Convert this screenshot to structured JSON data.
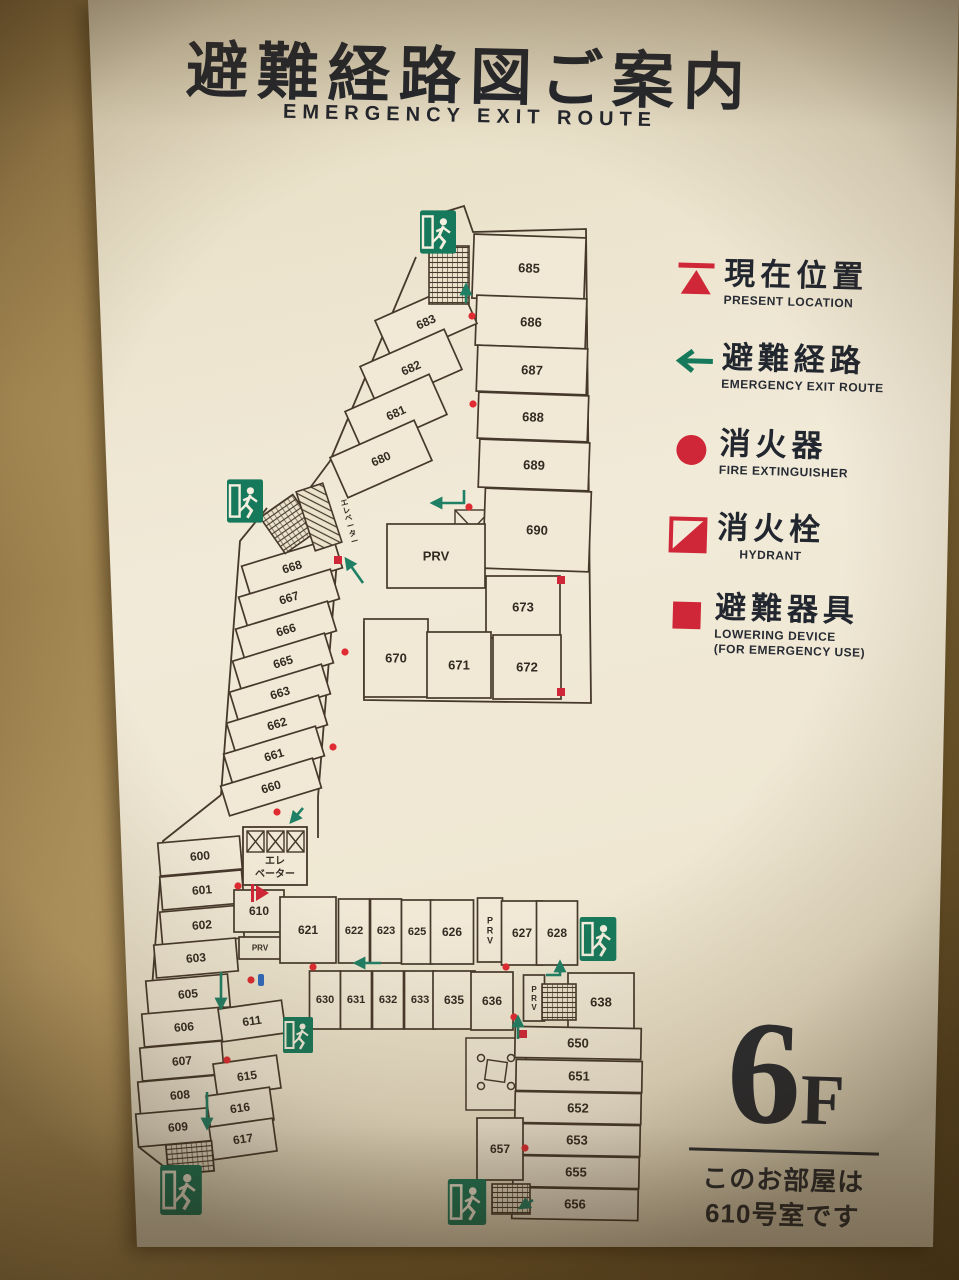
{
  "title": {
    "jp": "避難経路図ご案内",
    "en": "EMERGENCY EXIT ROUTE"
  },
  "legend": {
    "items": [
      {
        "id": "present-location",
        "jp": "現在位置",
        "en": "PRESENT LOCATION"
      },
      {
        "id": "exit-route",
        "jp": "避難経路",
        "en": "EMERGENCY EXIT ROUTE"
      },
      {
        "id": "fire-extinguisher",
        "jp": "消火器",
        "en": "FIRE EXTINGUISHER"
      },
      {
        "id": "hydrant",
        "jp": "消火栓",
        "en": "HYDRANT"
      },
      {
        "id": "lowering-device",
        "jp": "避難器具",
        "en": "LOWERING DEVICE",
        "en2": "(FOR EMERGENCY USE)"
      }
    ]
  },
  "floor": {
    "number": "6",
    "suffix": "F",
    "note1": "このお部屋は",
    "note2": "610号室です"
  },
  "colors": {
    "sign": "#efe7d2",
    "wall_paint": "#9c8150",
    "accent_red": "#d02738",
    "exit_green": "#17795b",
    "plan_line": "#46392b",
    "ink": "#22262e",
    "hose_blue": "#2f6bbf"
  },
  "plan": {
    "elevator": {
      "line1": "エレ",
      "line2": "ベーター"
    },
    "shaft_label": "エレベーター",
    "rooms": [
      {
        "t": "685",
        "x": 529,
        "y": 268,
        "w": 112,
        "h": 64,
        "r": 2
      },
      {
        "t": "686",
        "x": 531,
        "y": 322,
        "w": 110,
        "h": 50,
        "r": 2
      },
      {
        "t": "687",
        "x": 532,
        "y": 370,
        "w": 110,
        "h": 46,
        "r": 2
      },
      {
        "t": "688",
        "x": 533,
        "y": 417,
        "w": 110,
        "h": 46,
        "r": 2
      },
      {
        "t": "689",
        "x": 534,
        "y": 465,
        "w": 110,
        "h": 48,
        "r": 2
      },
      {
        "t": "690",
        "x": 537,
        "y": 530,
        "w": 106,
        "h": 80,
        "r": 2
      },
      {
        "t": "PRV",
        "x": 436,
        "y": 556,
        "w": 98,
        "h": 64,
        "r": 0,
        "fs": 13
      },
      {
        "t": "673",
        "x": 523,
        "y": 607,
        "w": 74,
        "h": 62,
        "r": 0
      },
      {
        "t": "670",
        "x": 396,
        "y": 658,
        "w": 64,
        "h": 78,
        "r": 0
      },
      {
        "t": "671",
        "x": 459,
        "y": 665,
        "w": 64,
        "h": 66,
        "r": 0
      },
      {
        "t": "672",
        "x": 527,
        "y": 667,
        "w": 68,
        "h": 64,
        "r": 0
      },
      {
        "t": "683",
        "x": 426,
        "y": 322,
        "w": 92,
        "h": 44,
        "r": -24,
        "fs": 12
      },
      {
        "t": "682",
        "x": 411,
        "y": 368,
        "w": 92,
        "h": 44,
        "r": -24,
        "fs": 12
      },
      {
        "t": "681",
        "x": 396,
        "y": 413,
        "w": 92,
        "h": 44,
        "r": -24,
        "fs": 12
      },
      {
        "t": "680",
        "x": 381,
        "y": 459,
        "w": 92,
        "h": 44,
        "r": -24,
        "fs": 12
      },
      {
        "t": "668",
        "x": 292,
        "y": 567,
        "w": 96,
        "h": 31,
        "r": -17,
        "fs": 12
      },
      {
        "t": "667",
        "x": 289,
        "y": 598,
        "w": 96,
        "h": 31,
        "r": -17,
        "fs": 12
      },
      {
        "t": "666",
        "x": 286,
        "y": 630,
        "w": 96,
        "h": 31,
        "r": -17,
        "fs": 12
      },
      {
        "t": "665",
        "x": 283,
        "y": 662,
        "w": 96,
        "h": 31,
        "r": -17,
        "fs": 12
      },
      {
        "t": "663",
        "x": 280,
        "y": 693,
        "w": 96,
        "h": 31,
        "r": -17,
        "fs": 12
      },
      {
        "t": "662",
        "x": 277,
        "y": 724,
        "w": 96,
        "h": 31,
        "r": -17,
        "fs": 12
      },
      {
        "t": "661",
        "x": 274,
        "y": 755,
        "w": 96,
        "h": 31,
        "r": -17,
        "fs": 12
      },
      {
        "t": "660",
        "x": 271,
        "y": 787,
        "w": 96,
        "h": 31,
        "r": -17,
        "fs": 12
      },
      {
        "t": "600",
        "x": 200,
        "y": 856,
        "w": 82,
        "h": 33,
        "r": -5,
        "fs": 12
      },
      {
        "t": "601",
        "x": 202,
        "y": 890,
        "w": 82,
        "h": 33,
        "r": -5,
        "fs": 12
      },
      {
        "t": "602",
        "x": 202,
        "y": 925,
        "w": 82,
        "h": 33,
        "r": -5,
        "fs": 12
      },
      {
        "t": "603",
        "x": 196,
        "y": 958,
        "w": 82,
        "h": 33,
        "r": -5,
        "fs": 12
      },
      {
        "t": "605",
        "x": 188,
        "y": 994,
        "w": 82,
        "h": 33,
        "r": -5,
        "fs": 12
      },
      {
        "t": "606",
        "x": 184,
        "y": 1027,
        "w": 82,
        "h": 33,
        "r": -5,
        "fs": 12
      },
      {
        "t": "607",
        "x": 182,
        "y": 1061,
        "w": 82,
        "h": 33,
        "r": -5,
        "fs": 12
      },
      {
        "t": "608",
        "x": 180,
        "y": 1095,
        "w": 82,
        "h": 33,
        "r": -5,
        "fs": 12
      },
      {
        "t": "609",
        "x": 178,
        "y": 1127,
        "w": 82,
        "h": 33,
        "r": -5,
        "fs": 12
      },
      {
        "t": "610",
        "x": 259,
        "y": 911,
        "w": 50,
        "h": 42,
        "r": 0,
        "fs": 12
      },
      {
        "t": "PRV",
        "x": 260,
        "y": 948,
        "w": 42,
        "h": 22,
        "r": 0,
        "fs": 8
      },
      {
        "t": "611",
        "x": 252,
        "y": 1021,
        "w": 64,
        "h": 33,
        "r": -8,
        "fs": 12
      },
      {
        "t": "615",
        "x": 247,
        "y": 1076,
        "w": 64,
        "h": 33,
        "r": -8,
        "fs": 12
      },
      {
        "t": "616",
        "x": 240,
        "y": 1108,
        "w": 64,
        "h": 33,
        "r": -8,
        "fs": 12
      },
      {
        "t": "617",
        "x": 243,
        "y": 1139,
        "w": 64,
        "h": 33,
        "r": -8,
        "fs": 12
      },
      {
        "t": "621",
        "x": 308,
        "y": 930,
        "w": 56,
        "h": 66,
        "r": 0,
        "fs": 12
      },
      {
        "t": "622",
        "x": 354,
        "y": 931,
        "w": 31,
        "h": 64,
        "r": 0,
        "fs": 11
      },
      {
        "t": "623",
        "x": 386,
        "y": 931,
        "w": 31,
        "h": 64,
        "r": 0,
        "fs": 11
      },
      {
        "t": "625",
        "x": 417,
        "y": 932,
        "w": 31,
        "h": 64,
        "r": 0,
        "fs": 11
      },
      {
        "t": "626",
        "x": 452,
        "y": 932,
        "w": 43,
        "h": 64,
        "r": 0,
        "fs": 12
      },
      {
        "t": "PRV",
        "x": 490,
        "y": 930,
        "w": 25,
        "h": 64,
        "r": 0,
        "fs": 9,
        "vert": true
      },
      {
        "t": "627",
        "x": 522,
        "y": 933,
        "w": 41,
        "h": 64,
        "r": 0,
        "fs": 12
      },
      {
        "t": "628",
        "x": 557,
        "y": 933,
        "w": 41,
        "h": 64,
        "r": 0,
        "fs": 12
      },
      {
        "t": "630",
        "x": 325,
        "y": 1000,
        "w": 31,
        "h": 58,
        "r": 0,
        "fs": 11
      },
      {
        "t": "631",
        "x": 356,
        "y": 1000,
        "w": 31,
        "h": 58,
        "r": 0,
        "fs": 11
      },
      {
        "t": "632",
        "x": 388,
        "y": 1000,
        "w": 31,
        "h": 58,
        "r": 0,
        "fs": 11
      },
      {
        "t": "633",
        "x": 420,
        "y": 1000,
        "w": 31,
        "h": 58,
        "r": 0,
        "fs": 11
      },
      {
        "t": "635",
        "x": 454,
        "y": 1000,
        "w": 42,
        "h": 58,
        "r": 0,
        "fs": 12
      },
      {
        "t": "636",
        "x": 492,
        "y": 1001,
        "w": 42,
        "h": 58,
        "r": 0,
        "fs": 12
      },
      {
        "t": "PRV",
        "x": 534,
        "y": 998,
        "w": 21,
        "h": 46,
        "r": 0,
        "fs": 8,
        "vert": true
      },
      {
        "t": "638",
        "x": 601,
        "y": 1002,
        "w": 66,
        "h": 58,
        "r": 0,
        "fs": 13
      },
      {
        "t": "650",
        "x": 578,
        "y": 1043,
        "w": 126,
        "h": 31,
        "r": 1,
        "fs": 13
      },
      {
        "t": "651",
        "x": 579,
        "y": 1076,
        "w": 126,
        "h": 31,
        "r": 1,
        "fs": 13
      },
      {
        "t": "652",
        "x": 578,
        "y": 1108,
        "w": 126,
        "h": 31,
        "r": 1,
        "fs": 13
      },
      {
        "t": "653",
        "x": 577,
        "y": 1140,
        "w": 126,
        "h": 31,
        "r": 1,
        "fs": 13
      },
      {
        "t": "655",
        "x": 576,
        "y": 1172,
        "w": 126,
        "h": 31,
        "r": 1,
        "fs": 13
      },
      {
        "t": "656",
        "x": 575,
        "y": 1204,
        "w": 126,
        "h": 31,
        "r": 1,
        "fs": 13
      },
      {
        "t": "657",
        "x": 500,
        "y": 1149,
        "w": 46,
        "h": 62,
        "r": 0,
        "fs": 12
      }
    ],
    "stairs": [
      {
        "x": 449,
        "y": 275,
        "w": 40,
        "h": 58,
        "r": 0
      },
      {
        "x": 289,
        "y": 524,
        "w": 40,
        "h": 44,
        "r": -35
      },
      {
        "x": 319,
        "y": 517,
        "w": 28,
        "h": 62,
        "r": -18,
        "diag": true
      },
      {
        "x": 559,
        "y": 1002,
        "w": 34,
        "h": 36,
        "r": 0
      },
      {
        "x": 190,
        "y": 1158,
        "w": 46,
        "h": 30,
        "r": -5
      },
      {
        "x": 511,
        "y": 1199,
        "w": 38,
        "h": 30,
        "r": 0
      }
    ],
    "exits": [
      {
        "x": 438,
        "y": 232,
        "w": 36,
        "h": 46
      },
      {
        "x": 245,
        "y": 501,
        "w": 36,
        "h": 48
      },
      {
        "x": 598,
        "y": 939,
        "w": 40,
        "h": 44
      },
      {
        "x": 298,
        "y": 1035,
        "w": 30,
        "h": 40
      },
      {
        "x": 181,
        "y": 1190,
        "w": 46,
        "h": 50
      },
      {
        "x": 467,
        "y": 1202,
        "w": 40,
        "h": 46
      }
    ],
    "extinguishers": [
      [
        472,
        316
      ],
      [
        473,
        404
      ],
      [
        469,
        507
      ],
      [
        345,
        652
      ],
      [
        333,
        747
      ],
      [
        277,
        812
      ],
      [
        238,
        886
      ],
      [
        227,
        1060
      ],
      [
        313,
        967
      ],
      [
        506,
        967
      ],
      [
        514,
        1017
      ],
      [
        525,
        1148
      ],
      [
        251,
        980
      ]
    ],
    "lowering_devices": [
      [
        338,
        560
      ],
      [
        561,
        580
      ],
      [
        561,
        692
      ],
      [
        523,
        1034
      ]
    ],
    "hose_points": [
      [
        261,
        980
      ]
    ],
    "arrows": [
      [
        [
          466,
          303
        ],
        [
          466,
          285
        ]
      ],
      [
        [
          464,
          490
        ],
        [
          464,
          503
        ],
        [
          432,
          503
        ]
      ],
      [
        [
          363,
          583
        ],
        [
          346,
          559
        ]
      ],
      [
        [
          221,
          972
        ],
        [
          221,
          1008
        ]
      ],
      [
        [
          207,
          1092
        ],
        [
          207,
          1128
        ]
      ],
      [
        [
          381,
          963
        ],
        [
          355,
          963
        ]
      ],
      [
        [
          518,
          1039
        ],
        [
          518,
          1017
        ]
      ],
      [
        [
          546,
          975
        ],
        [
          560,
          975
        ],
        [
          560,
          962
        ]
      ],
      [
        [
          533,
          1200
        ],
        [
          520,
          1208
        ]
      ],
      [
        [
          303,
          808
        ],
        [
          291,
          822
        ]
      ]
    ],
    "present_location": {
      "x": 256,
      "y": 893
    }
  }
}
